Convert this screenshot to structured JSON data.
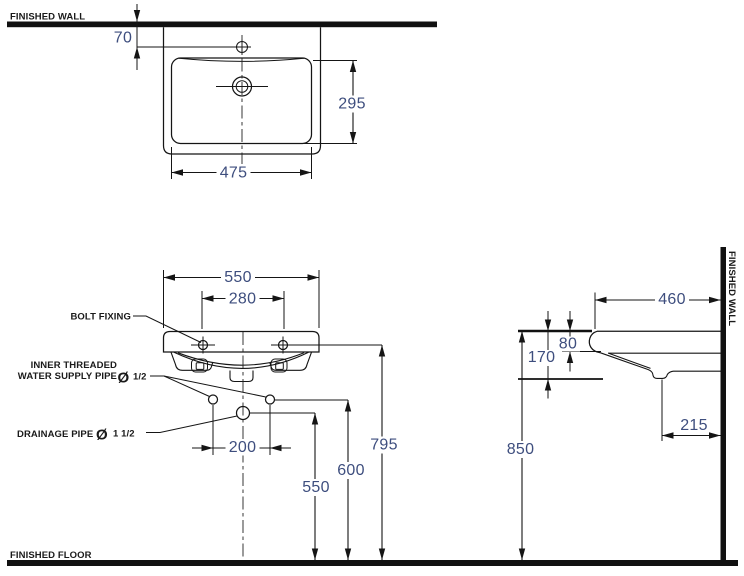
{
  "drawing": {
    "labels": {
      "finished_wall_top": "FINISHED WALL",
      "finished_wall_side": "FINISHED WALL",
      "finished_floor": "FINISHED FLOOR",
      "bolt_fixing": "BOLT FIXING",
      "supply_label_line1": "INNER THREADED",
      "supply_label_line2": "WATER SUPPLY PIPE",
      "supply_diameter_symbol": "Ø",
      "supply_diameter": "1/2",
      "drain_label": "DRAINAGE PIPE",
      "drain_diameter_symbol": "Ø",
      "drain_diameter": "1 1/2"
    },
    "dimensions_mm": {
      "faucet_hole_to_wall": "70",
      "basin_depth_plan": "295",
      "bowl_width": "475",
      "basin_width": "550",
      "bolt_spacing": "280",
      "supply_pipe_spacing": "200",
      "drain_pipe_height": "550",
      "supply_pipe_height": "600",
      "bolt_height": "795",
      "rim_height": "850",
      "basin_depth_side": "460",
      "rim_thickness": "80",
      "basin_body_height": "170",
      "drain_to_wall": "215"
    },
    "colors": {
      "line": "#151515",
      "dimension_text": "#3e4e7e",
      "label_text": "#1a1a1a"
    }
  }
}
